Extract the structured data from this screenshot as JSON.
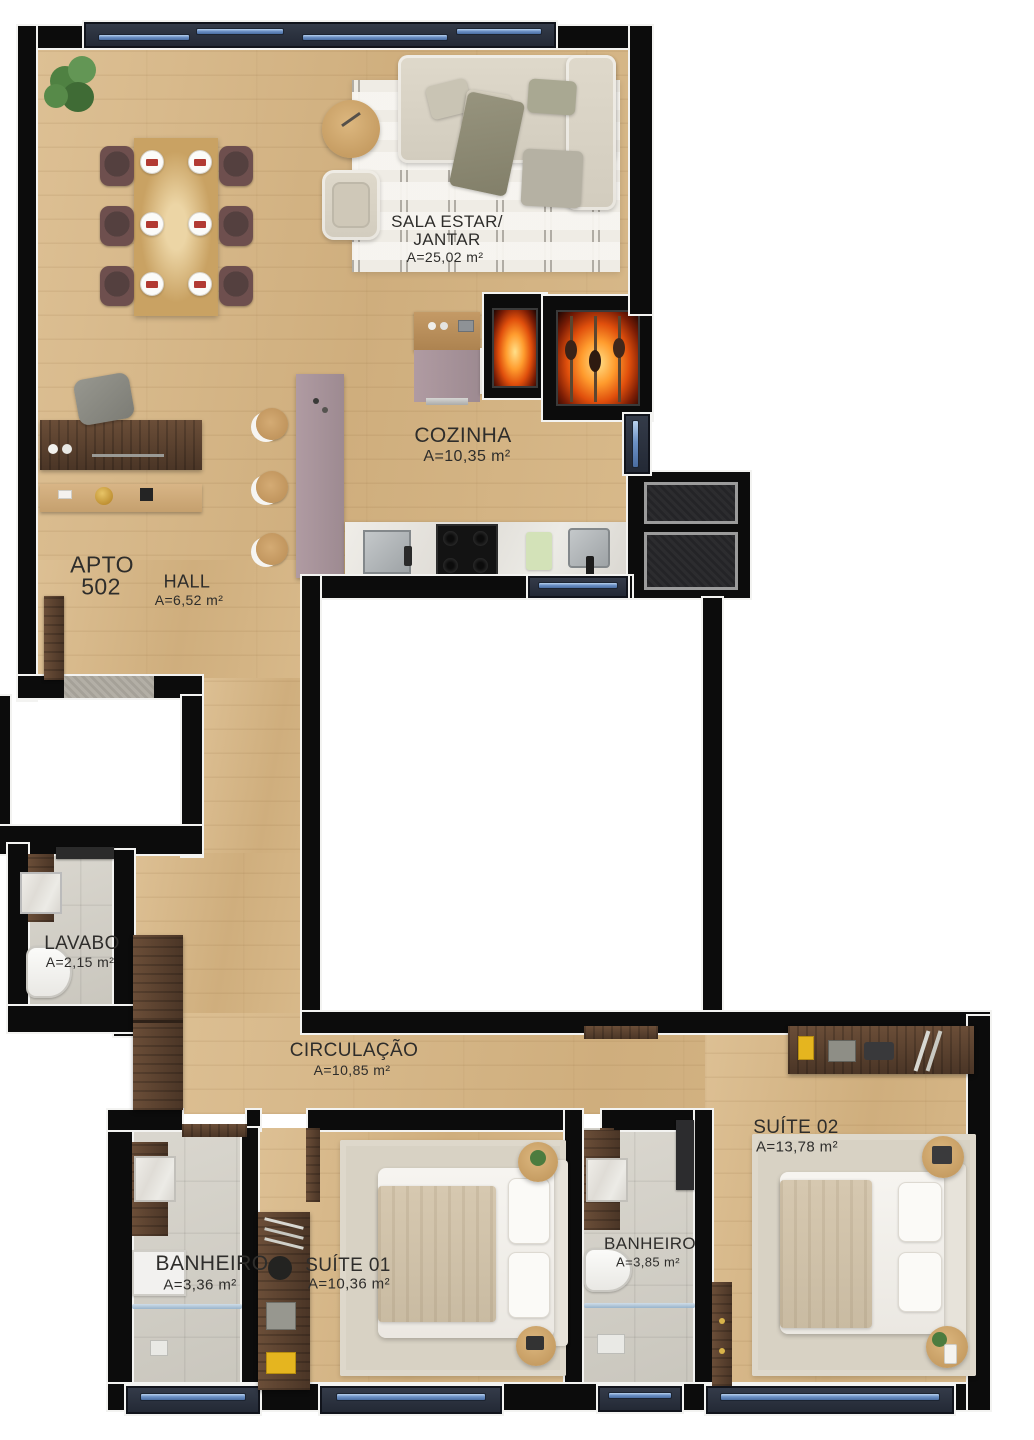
{
  "apartment": {
    "name": "APTO",
    "number": "502"
  },
  "rooms": [
    {
      "id": "sala",
      "name": "SALA ESTAR/",
      "name2": "JANTAR",
      "area": "A=25,02 m²"
    },
    {
      "id": "cozinha",
      "name": "COZINHA",
      "area": "A=10,35 m²"
    },
    {
      "id": "hall",
      "name": "HALL",
      "area": "A=6,52 m²"
    },
    {
      "id": "lavabo",
      "name": "LAVABO",
      "area": "A=2,15 m²"
    },
    {
      "id": "circulacao",
      "name": "CIRCULAÇÃO",
      "area": "A=10,85 m²"
    },
    {
      "id": "banheiro1",
      "name": "BANHEIRO",
      "area": "A=3,36 m²"
    },
    {
      "id": "suite1",
      "name": "SUÍTE 01",
      "area": "A=10,36 m²"
    },
    {
      "id": "banheiro2",
      "name": "BANHEIRO",
      "area": "A=3,85 m²"
    },
    {
      "id": "suite2",
      "name": "SUÍTE 02",
      "area": "A=13,78 m²"
    }
  ],
  "colors": {
    "wall": "#0c0c0c",
    "trim": "#f3f3f1",
    "wood_floor": "#d4b384",
    "tile_floor": "#d3d0c8",
    "island_mauve": "#a8939b",
    "window_frame": "#2a303d",
    "window_glass": "#6d92c6",
    "fire_accent": "#ff7a1a",
    "dark_wood": "#5a4132",
    "gold_accent": "#c9952c",
    "yellow_accent": "#e5b51f",
    "label_text": "#2e2d2b"
  }
}
